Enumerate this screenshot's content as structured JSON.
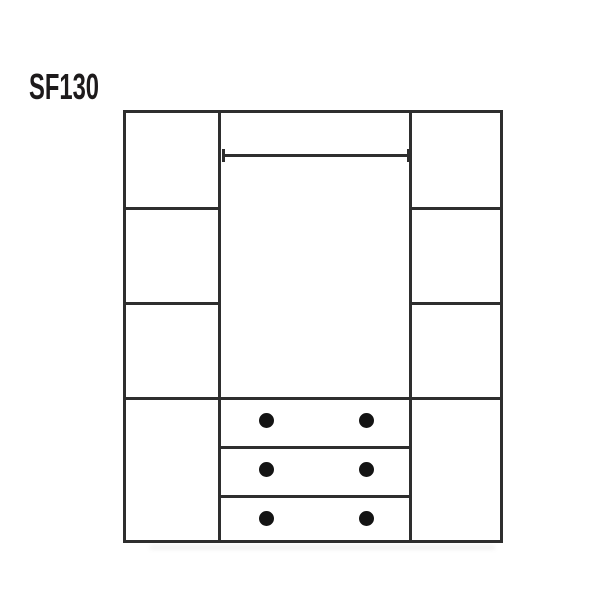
{
  "diagram": {
    "product_code": "SF130",
    "colors": {
      "line": "#2e2e2e",
      "knob": "#141414",
      "label": "#1d1a1b",
      "background": "#ffffff"
    },
    "icons": {
      "drawer_knob": "filled-circle",
      "dimension_line": "horizontal-bar-with-end-ticks"
    }
  }
}
